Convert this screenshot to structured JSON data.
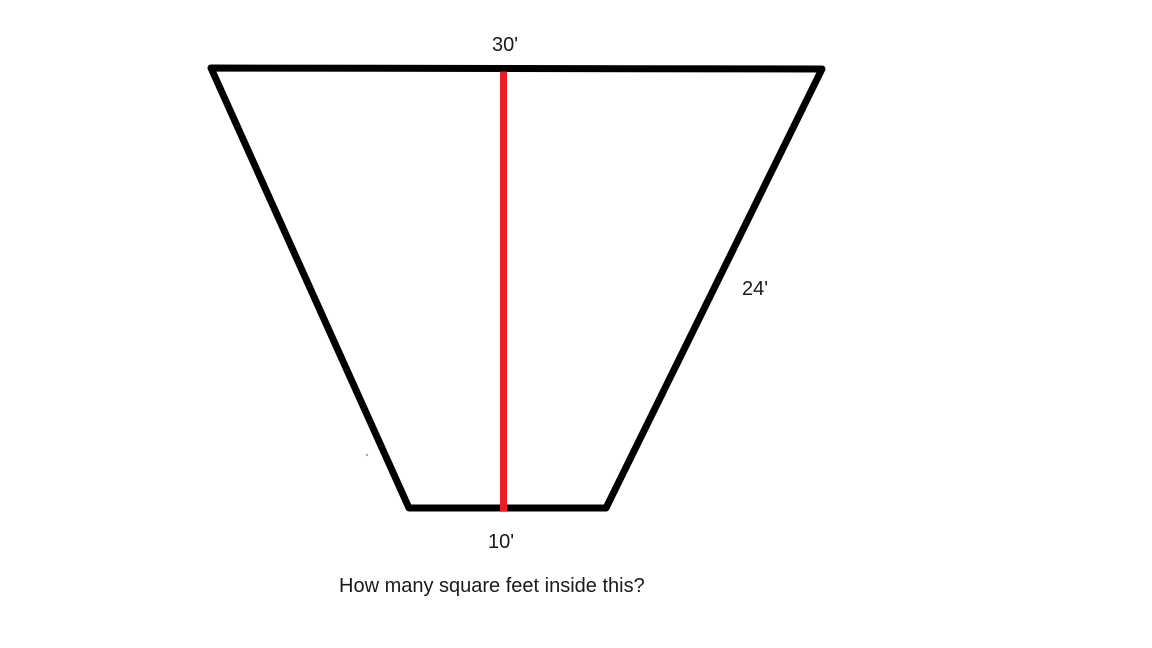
{
  "canvas": {
    "background": "#ffffff",
    "width": "1152",
    "height": "648"
  },
  "colors": {
    "outline": "#000000",
    "height_line": "#ED1C24",
    "stray_mark": "#a8a8a8",
    "text": "#1a1a1a"
  },
  "figure": {
    "type": "trapezoid",
    "polygon_points": "211,68 822,69 606,508 409,508",
    "stroke_width": "7",
    "height_line": {
      "x1": "503.5",
      "y1": "71.5",
      "x2": "503.5",
      "y2": "511"
    },
    "stray_mark": {
      "cx": "367",
      "cy": "455",
      "r": "1.2"
    }
  },
  "labels": {
    "top_side": "30'",
    "right_side": "24'",
    "bottom_side": "10'"
  },
  "question": {
    "text": "How many square feet inside this?"
  }
}
